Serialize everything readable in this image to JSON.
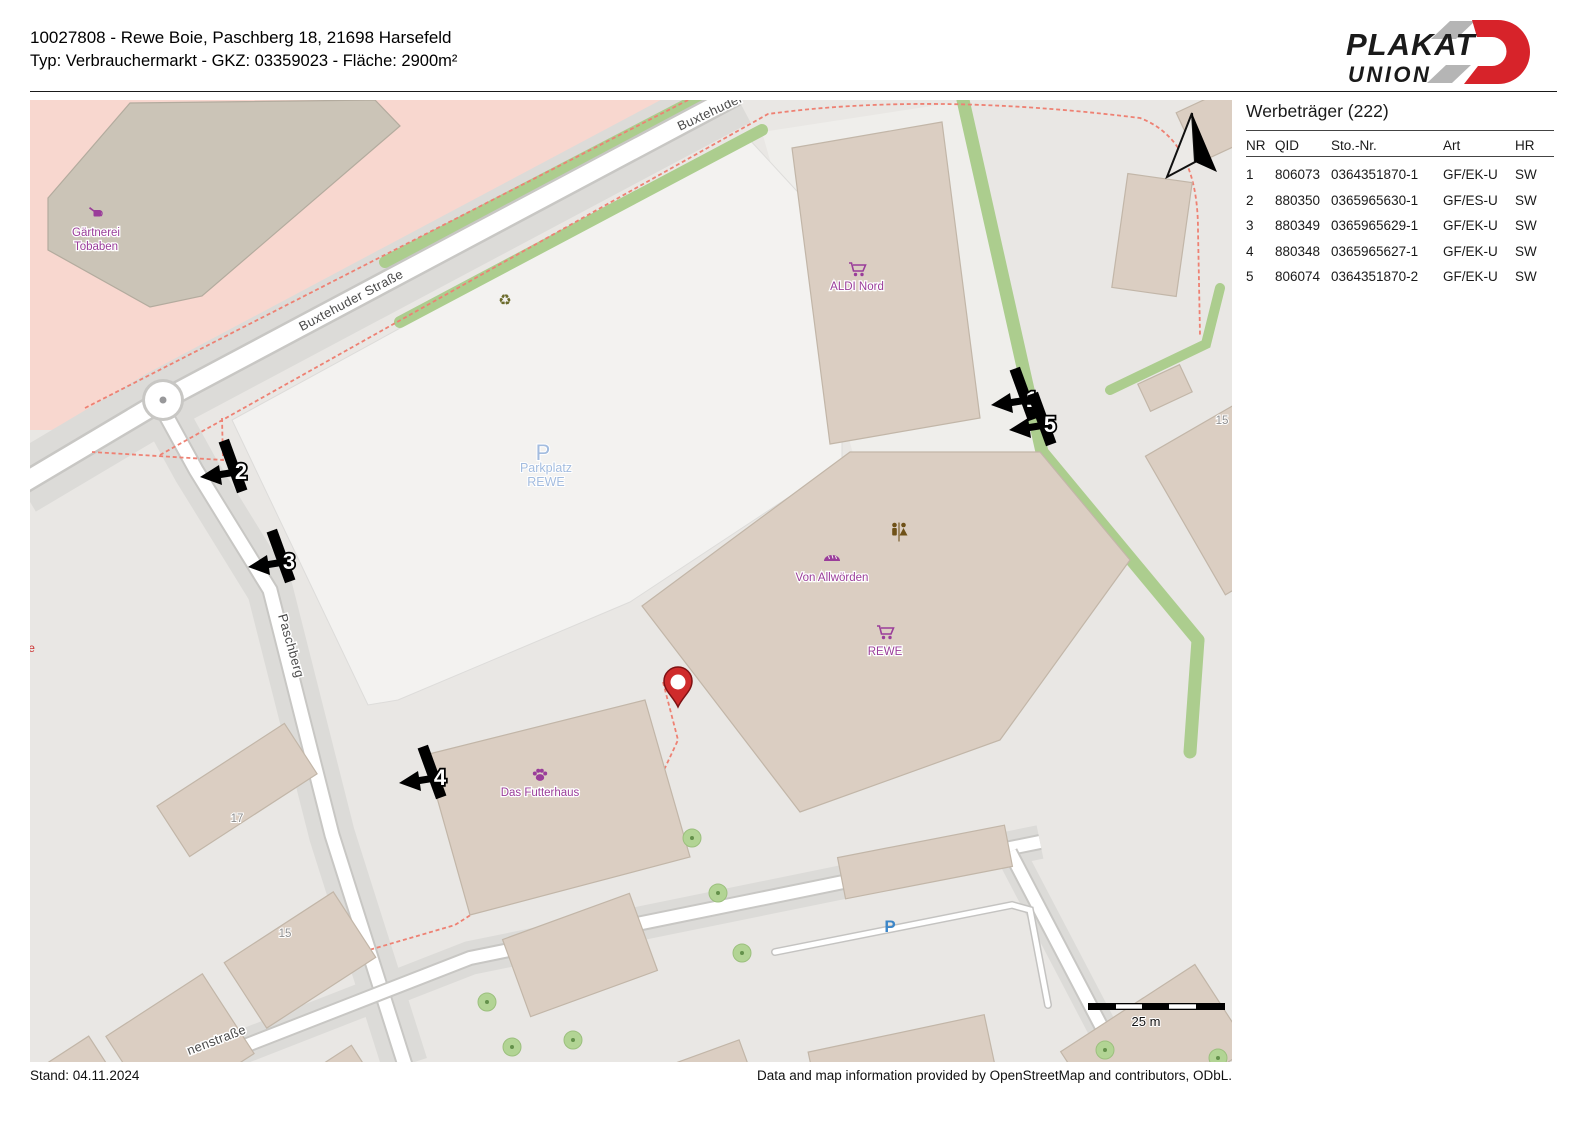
{
  "header": {
    "line1": "10027808 - Rewe Boie, Paschberg 18, 21698 Harsefeld",
    "line2": "Typ: Verbrauchermarkt - GKZ: 03359023 - Fläche: 2900m²"
  },
  "logo": {
    "line1": "PLAKAT",
    "line2": "UNION"
  },
  "panel": {
    "title": "Werbeträger (222)",
    "columns": [
      "NR",
      "QID",
      "Sto.-Nr.",
      "Art",
      "HR"
    ],
    "rows": [
      {
        "nr": "1",
        "qid": "806073",
        "sto": "0364351870-1",
        "art": "GF/EK-U",
        "hr": "SW"
      },
      {
        "nr": "2",
        "qid": "880350",
        "sto": "0365965630-1",
        "art": "GF/ES-U",
        "hr": "SW"
      },
      {
        "nr": "3",
        "qid": "880349",
        "sto": "0365965629-1",
        "art": "GF/EK-U",
        "hr": "SW"
      },
      {
        "nr": "4",
        "qid": "880348",
        "sto": "0365965627-1",
        "art": "GF/EK-U",
        "hr": "SW"
      },
      {
        "nr": "5",
        "qid": "806074",
        "sto": "0364351870-2",
        "art": "GF/EK-U",
        "hr": "SW"
      }
    ]
  },
  "map": {
    "street_labels": {
      "buxtehuder": "Buxtehuder Straße",
      "buxtehuder_top": "Buxtehuder",
      "paschberg": "Paschberg",
      "bottom": "nenstraße"
    },
    "pois": {
      "gaertnerei1": "Gärtnerei",
      "gaertnerei2": "Tobaben",
      "aldi": "ALDI Nord",
      "von_allwoerden": "Von Allwörden",
      "rewe": "REWE",
      "futterhaus": "Das Futterhaus"
    },
    "parking": {
      "p": "P",
      "line1": "Parkplatz",
      "line2": "REWE",
      "small_p": "P"
    },
    "house_numbers": {
      "n17": "17",
      "n15a": "15",
      "n15b": "15"
    },
    "edge_label": "ie",
    "recycle_glyph": "♻",
    "markers": [
      {
        "n": "1"
      },
      {
        "n": "2"
      },
      {
        "n": "3"
      },
      {
        "n": "4"
      },
      {
        "n": "5"
      }
    ],
    "scale_label": "25 m",
    "colors": {
      "brand_red": "#d7232a",
      "pin_red": "#cf2b2b",
      "marker_black": "#000000",
      "poi_purple": "#9a3d9a",
      "parking_blue": "#a3bcdf",
      "green_strip": "#accd8e",
      "retail_pink": "#f8d7cf"
    }
  },
  "footer": {
    "left": "Stand: 04.11.2024",
    "right": "Data and map information provided by OpenStreetMap and contributors, ODbL."
  }
}
